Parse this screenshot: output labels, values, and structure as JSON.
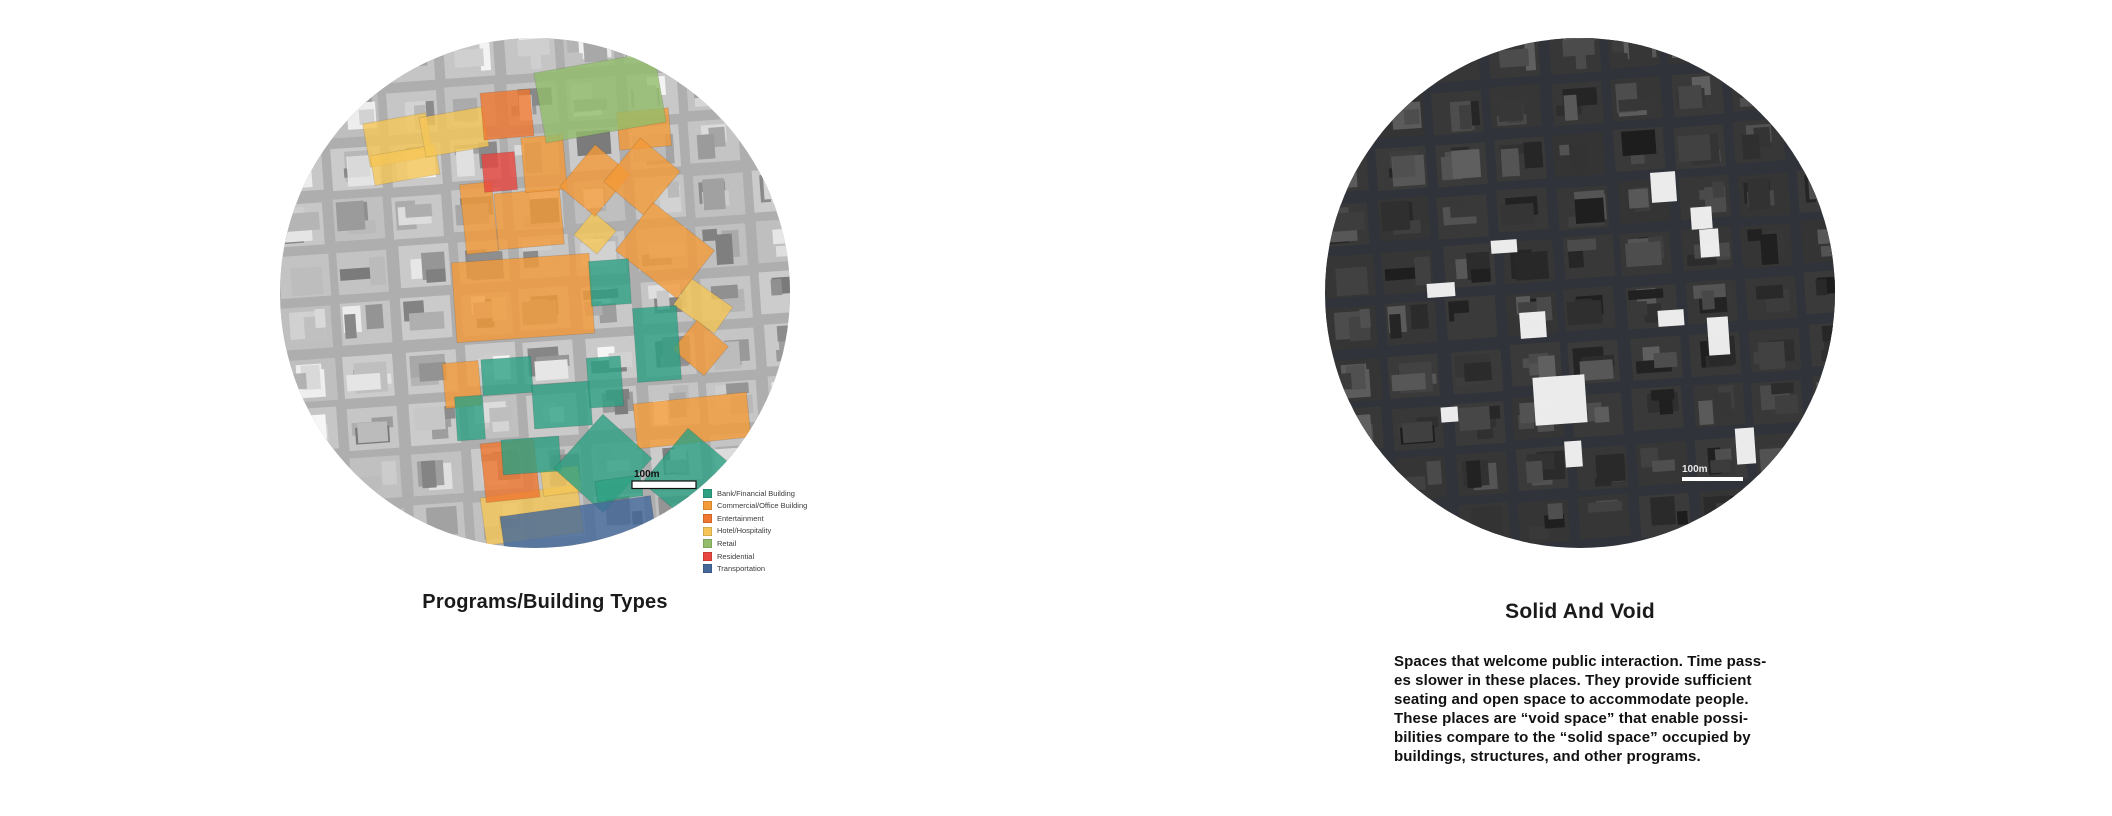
{
  "page": {
    "background": "#ffffff"
  },
  "left_figure": {
    "title": "Programs/Building Types",
    "scale_label": "100m",
    "map_theme": {
      "base": "#aeaeae",
      "scale_text_color": "#111111",
      "scale_bar_fill": "#ffffff",
      "scale_bar_stroke": "#111111"
    },
    "legend": {
      "items": [
        {
          "key": "bank",
          "label": "Bank/Financial Building",
          "color": "#2ea183"
        },
        {
          "key": "commercial",
          "label": "Commercial/Office Building",
          "color": "#f49a38"
        },
        {
          "key": "entertainment",
          "label": "Entertainment",
          "color": "#ef7730"
        },
        {
          "key": "hotel",
          "label": "Hotel/Hospitality",
          "color": "#f5c657"
        },
        {
          "key": "retail",
          "label": "Retail",
          "color": "#93bd6b"
        },
        {
          "key": "residential",
          "label": "Residential",
          "color": "#e8463f"
        },
        {
          "key": "transportation",
          "label": "Transportation",
          "color": "#44689a"
        }
      ]
    },
    "buildings": [
      {
        "cat": "hotel",
        "x": 86,
        "y": 80,
        "w": 64,
        "h": 44,
        "rot": -10
      },
      {
        "cat": "hotel",
        "x": 92,
        "y": 112,
        "w": 66,
        "h": 30,
        "rot": -10
      },
      {
        "cat": "hotel",
        "x": 142,
        "y": 74,
        "w": 64,
        "h": 40,
        "rot": -10
      },
      {
        "cat": "hotel",
        "x": 300,
        "y": 180,
        "w": 30,
        "h": 30,
        "rot": 40
      },
      {
        "cat": "hotel",
        "x": 398,
        "y": 252,
        "w": 50,
        "h": 32,
        "rot": 35
      },
      {
        "cat": "hotel",
        "x": 203,
        "y": 453,
        "w": 98,
        "h": 48,
        "rot": -8
      },
      {
        "cat": "hotel",
        "x": 262,
        "y": 430,
        "w": 38,
        "h": 26,
        "rot": -8
      },
      {
        "cat": "commercial",
        "x": 174,
        "y": 220,
        "w": 138,
        "h": 80,
        "rot": -4
      },
      {
        "cat": "commercial",
        "x": 183,
        "y": 145,
        "w": 32,
        "h": 70,
        "rot": -6
      },
      {
        "cat": "commercial",
        "x": 216,
        "y": 153,
        "w": 66,
        "h": 56,
        "rot": -5
      },
      {
        "cat": "commercial",
        "x": 243,
        "y": 98,
        "w": 42,
        "h": 55,
        "rot": -5
      },
      {
        "cat": "commercial",
        "x": 292,
        "y": 115,
        "w": 46,
        "h": 55,
        "rot": 40
      },
      {
        "cat": "commercial",
        "x": 338,
        "y": 72,
        "w": 52,
        "h": 38,
        "rot": -5
      },
      {
        "cat": "commercial",
        "x": 336,
        "y": 110,
        "w": 52,
        "h": 57,
        "rot": 40
      },
      {
        "cat": "commercial",
        "x": 346,
        "y": 182,
        "w": 78,
        "h": 61,
        "rot": 38
      },
      {
        "cat": "commercial",
        "x": 400,
        "y": 291,
        "w": 41,
        "h": 38,
        "rot": 40
      },
      {
        "cat": "commercial",
        "x": 355,
        "y": 360,
        "w": 114,
        "h": 45,
        "rot": -6
      },
      {
        "cat": "commercial",
        "x": 164,
        "y": 324,
        "w": 36,
        "h": 45,
        "rot": -5
      },
      {
        "cat": "entertainment",
        "x": 202,
        "y": 53,
        "w": 50,
        "h": 47,
        "rot": -5
      },
      {
        "cat": "entertainment",
        "x": 203,
        "y": 403,
        "w": 54,
        "h": 59,
        "rot": -6
      },
      {
        "cat": "residential",
        "x": 203,
        "y": 115,
        "w": 33,
        "h": 38,
        "rot": -5
      },
      {
        "cat": "retail",
        "x": 259,
        "y": 24,
        "w": 122,
        "h": 71,
        "rot": -10
      },
      {
        "cat": "bank",
        "x": 310,
        "y": 222,
        "w": 40,
        "h": 45,
        "rot": -4
      },
      {
        "cat": "bank",
        "x": 355,
        "y": 269,
        "w": 44,
        "h": 74,
        "rot": -4
      },
      {
        "cat": "bank",
        "x": 202,
        "y": 320,
        "w": 50,
        "h": 36,
        "rot": -4
      },
      {
        "cat": "bank",
        "x": 253,
        "y": 345,
        "w": 58,
        "h": 44,
        "rot": -4
      },
      {
        "cat": "bank",
        "x": 308,
        "y": 319,
        "w": 34,
        "h": 50,
        "rot": -4
      },
      {
        "cat": "bank",
        "x": 176,
        "y": 358,
        "w": 28,
        "h": 44,
        "rot": -4
      },
      {
        "cat": "bank",
        "x": 222,
        "y": 400,
        "w": 58,
        "h": 35,
        "rot": -4
      },
      {
        "cat": "bank",
        "x": 290,
        "y": 389,
        "w": 66,
        "h": 73,
        "rot": 42
      },
      {
        "cat": "bank",
        "x": 376,
        "y": 407,
        "w": 78,
        "h": 71,
        "rot": 40
      },
      {
        "cat": "bank",
        "x": 316,
        "y": 440,
        "w": 46,
        "h": 21,
        "rot": -8
      },
      {
        "cat": "transportation",
        "x": 222,
        "y": 468,
        "w": 152,
        "h": 40,
        "rot": -8
      }
    ]
  },
  "right_figure": {
    "title": "Solid And Void",
    "scale_label": "100m",
    "map_theme": {
      "base": "#303339",
      "void_fill": "#f2f2f2",
      "scale_text_color": "#e8e8e8",
      "scale_bar_fill": "#ffffff"
    },
    "description_lines": [
      "Spaces that welcome public interaction. Time pass-",
      "es slower in these places. They provide sufficient",
      "seating and open space to accommodate people.",
      "These places are “void space” that enable possi-",
      "bilities compare to the “solid space” occupied by",
      "buildings, structures, and other programs."
    ],
    "voids": [
      {
        "x": 326,
        "y": 134,
        "w": 25,
        "h": 30,
        "rot": -4
      },
      {
        "x": 366,
        "y": 169,
        "w": 21,
        "h": 22,
        "rot": -4
      },
      {
        "x": 375,
        "y": 191,
        "w": 19,
        "h": 28,
        "rot": -4
      },
      {
        "x": 166,
        "y": 202,
        "w": 26,
        "h": 13,
        "rot": -4
      },
      {
        "x": 102,
        "y": 245,
        "w": 28,
        "h": 14,
        "rot": -4
      },
      {
        "x": 195,
        "y": 274,
        "w": 26,
        "h": 26,
        "rot": -4
      },
      {
        "x": 333,
        "y": 272,
        "w": 26,
        "h": 16,
        "rot": -4
      },
      {
        "x": 383,
        "y": 279,
        "w": 21,
        "h": 38,
        "rot": -4
      },
      {
        "x": 209,
        "y": 338,
        "w": 52,
        "h": 48,
        "rot": -4
      },
      {
        "x": 116,
        "y": 369,
        "w": 17,
        "h": 15,
        "rot": -4
      },
      {
        "x": 240,
        "y": 403,
        "w": 17,
        "h": 26,
        "rot": -4
      },
      {
        "x": 411,
        "y": 390,
        "w": 19,
        "h": 36,
        "rot": -4
      }
    ]
  }
}
